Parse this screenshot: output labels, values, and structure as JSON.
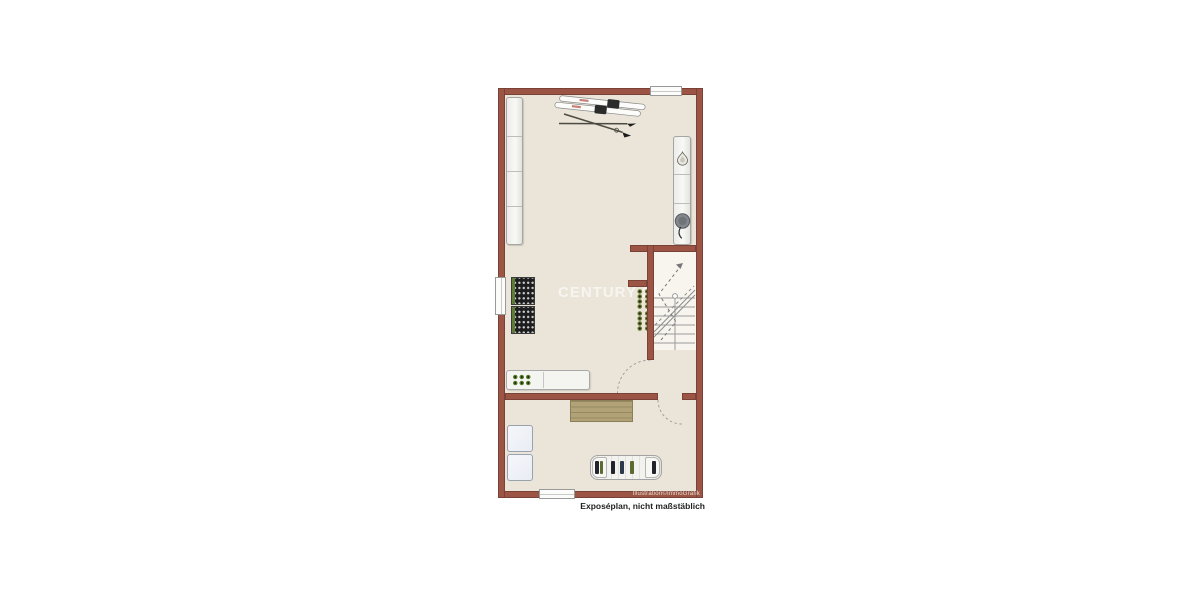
{
  "page": {
    "background": "#ffffff"
  },
  "plan": {
    "caption": "Exposéplan, nicht maßstäblich",
    "credit": "Illustration©ImmoGrafik",
    "watermark": "CENTURY 21",
    "colors": {
      "wall": "#9c5445",
      "wall_edge": "#7a4236",
      "floor": "#eae5d8",
      "stair_floor": "#f7f5ee",
      "wood": "#b1a377",
      "wood_edge": "#8b7f57",
      "rack_dark": "#1d1d1d",
      "accent_green": "#5e7c36",
      "furniture": "#f4f4f1",
      "furniture_edge": "#a9a9a9",
      "line_grey": "#9a9a9a"
    },
    "icons": [
      "skis-icon",
      "flame-icon",
      "boiler-icon",
      "staircase-icon",
      "door-swing-arc-icon",
      "plant-dots-icon",
      "bottle-rack-icon",
      "storage-rack-icon",
      "window-icon"
    ]
  }
}
